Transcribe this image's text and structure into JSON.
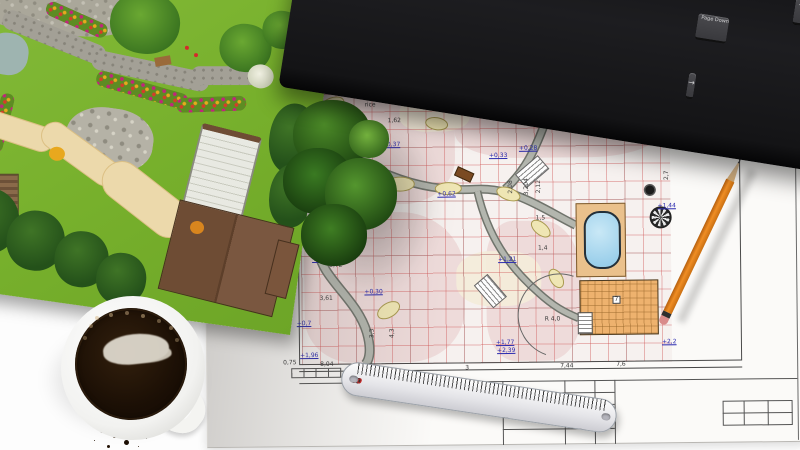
{
  "scene": {
    "background_color": "#ffffff",
    "objects": [
      "garden-3d-render-print",
      "landscape-blueprint-sheet",
      "computer-keyboard",
      "pencil",
      "ruler",
      "coffee-cup",
      "coffee-grounds"
    ]
  },
  "keyboard": {
    "body_color": "#1b1b1d",
    "key_color": "#3f3f43",
    "rows": {
      "num": [
        {
          "t": "`"
        },
        {
          "t": "1"
        },
        {
          "t": "2"
        },
        {
          "t": "3"
        },
        {
          "t": "4"
        },
        {
          "t": "5"
        },
        {
          "t": "6"
        },
        {
          "t": "7"
        },
        {
          "t": "8"
        },
        {
          "t": "9"
        },
        {
          "t": "0"
        },
        {
          "t": "-"
        },
        {
          "t": "="
        },
        {
          "t": "← Backspace",
          "w": 52
        }
      ],
      "tab": [
        {
          "t": "Tab",
          "w": 36
        },
        {
          "t": "Q"
        },
        {
          "t": "W"
        },
        {
          "t": "E"
        },
        {
          "t": "R"
        },
        {
          "t": "T"
        },
        {
          "t": "Y"
        },
        {
          "t": "U"
        },
        {
          "t": "I"
        },
        {
          "t": "O"
        },
        {
          "t": "P"
        },
        {
          "t": "["
        },
        {
          "t": "]"
        }
      ],
      "caps": [
        {
          "t": "Caps Lock",
          "w": 42
        },
        {
          "t": "A"
        },
        {
          "t": "S"
        },
        {
          "t": "D"
        },
        {
          "t": "F"
        },
        {
          "t": "G"
        },
        {
          "t": "H"
        },
        {
          "t": "J"
        },
        {
          "t": "K"
        },
        {
          "t": "L"
        },
        {
          "t": ";"
        },
        {
          "t": "'"
        },
        {
          "t": "Enter ↵",
          "w": 46
        }
      ],
      "shift": [
        {
          "t": "⇧ Shift",
          "w": 54
        },
        {
          "t": "Z"
        },
        {
          "t": "X"
        },
        {
          "t": "C"
        },
        {
          "t": "V"
        },
        {
          "t": "B"
        },
        {
          "t": "N"
        },
        {
          "t": "M"
        },
        {
          "t": ","
        },
        {
          "t": "."
        },
        {
          "t": "/"
        },
        {
          "t": "⇧ Shift",
          "w": 44
        }
      ],
      "ctrl": [
        {
          "t": "Ctrl",
          "w": 30
        },
        {
          "t": "Win",
          "w": 26
        },
        {
          "t": "Alt",
          "w": 28
        },
        {
          "t": "",
          "w": 150
        },
        {
          "t": "Alt",
          "w": 28
        },
        {
          "t": "▤",
          "w": 26
        },
        {
          "t": "Ctrl",
          "w": 30
        }
      ],
      "nav": [
        {
          "t": "Insert"
        },
        {
          "t": "Home"
        },
        {
          "t": "Page Up"
        },
        {
          "t": "Delete"
        },
        {
          "t": "End"
        },
        {
          "t": "Page Down"
        }
      ],
      "arrows": [
        {
          "t": ""
        },
        {
          "t": "↑"
        },
        {
          "t": ""
        },
        {
          "t": "←"
        },
        {
          "t": "↓"
        },
        {
          "t": "→"
        }
      ],
      "numpad": [
        {
          "t": "Num Lock"
        },
        {
          "t": "/"
        },
        {
          "t": "*"
        },
        {
          "t": "-"
        },
        {
          "t": "7"
        },
        {
          "t": "8"
        },
        {
          "t": "9"
        },
        {
          "t": "+"
        },
        {
          "t": "4"
        },
        {
          "t": "5"
        },
        {
          "t": "6"
        },
        {
          "t": "↵"
        },
        {
          "t": "1"
        },
        {
          "t": "2"
        },
        {
          "t": "3"
        },
        {
          "t": "0"
        },
        {
          "t": ". Del"
        }
      ]
    }
  },
  "ruler": {
    "numbers": [
      "1",
      "2",
      "3",
      "4",
      "5",
      "6",
      "7",
      "8",
      "9",
      "10",
      "11",
      "12",
      "13",
      "14",
      "15",
      "16",
      "17",
      "18",
      "19",
      "20"
    ],
    "red_numbers": [
      "10",
      "20"
    ],
    "red_color": "#c22525"
  },
  "blueprint": {
    "elevation_color": "#2b2bb0",
    "elevations": [
      {
        "t": "+0,02",
        "x": 151,
        "y": 66
      },
      {
        "t": "+0,37",
        "x": 177,
        "y": 80
      },
      {
        "t": "+0,28",
        "x": 314,
        "y": 85
      },
      {
        "t": "+0,33",
        "x": 284,
        "y": 92
      },
      {
        "t": "+0,62",
        "x": 232,
        "y": 130
      },
      {
        "t": "+1,44",
        "x": 452,
        "y": 144
      },
      {
        "t": "+1,21",
        "x": 292,
        "y": 196
      },
      {
        "t": "+0,62",
        "x": 106,
        "y": 194
      },
      {
        "t": "+0,30",
        "x": 158,
        "y": 227
      },
      {
        "t": "+0,7",
        "x": 90,
        "y": 258
      },
      {
        "t": "+1,96",
        "x": 93,
        "y": 290
      },
      {
        "t": "+1,77",
        "x": 289,
        "y": 279
      },
      {
        "t": "+2,39",
        "x": 290,
        "y": 287
      },
      {
        "t": "+2,2",
        "x": 455,
        "y": 280
      }
    ],
    "dimensions": [
      {
        "t": "2,70",
        "x": 143,
        "y": 23
      },
      {
        "t": "rice",
        "x": 160,
        "y": 40
      },
      {
        "t": "50",
        "x": 225,
        "y": 40
      },
      {
        "t": "1,62",
        "x": 183,
        "y": 56
      },
      {
        "t": "1,37",
        "x": 123,
        "y": 81
      },
      {
        "t": "8,72",
        "x": 123,
        "y": 200
      },
      {
        "t": "3,61",
        "x": 113,
        "y": 233
      },
      {
        "t": "0,75",
        "x": 76,
        "y": 297
      },
      {
        "t": "8,04",
        "x": 113,
        "y": 299
      },
      {
        "t": "3",
        "x": 258,
        "y": 304
      },
      {
        "t": "7,44",
        "x": 353,
        "y": 303
      },
      {
        "t": "7,6",
        "x": 409,
        "y": 302
      },
      {
        "t": "R 4,0",
        "x": 338,
        "y": 256
      },
      {
        "t": "1,5",
        "x": 330,
        "y": 155
      },
      {
        "t": "1,4",
        "x": 332,
        "y": 185
      },
      {
        "t": "3,204",
        "x": 313,
        "y": 123,
        "rot": -90
      },
      {
        "t": "2,12",
        "x": 327,
        "y": 123,
        "rot": -90
      },
      {
        "t": "2,08",
        "x": 299,
        "y": 123,
        "rot": -90
      },
      {
        "t": "4,3",
        "x": 181,
        "y": 268,
        "rot": -90
      },
      {
        "t": "3,3",
        "x": 161,
        "y": 268,
        "rot": -90
      },
      {
        "t": "2,7",
        "x": 457,
        "y": 113,
        "rot": -90
      }
    ],
    "boxed_label": {
      "t": "7",
      "x": 406,
      "y": 238
    },
    "pool_color": "#8fc9e8",
    "deck_color": "#eac18c",
    "building_color": "#eeb26e",
    "grid_color": "#ce5252"
  }
}
